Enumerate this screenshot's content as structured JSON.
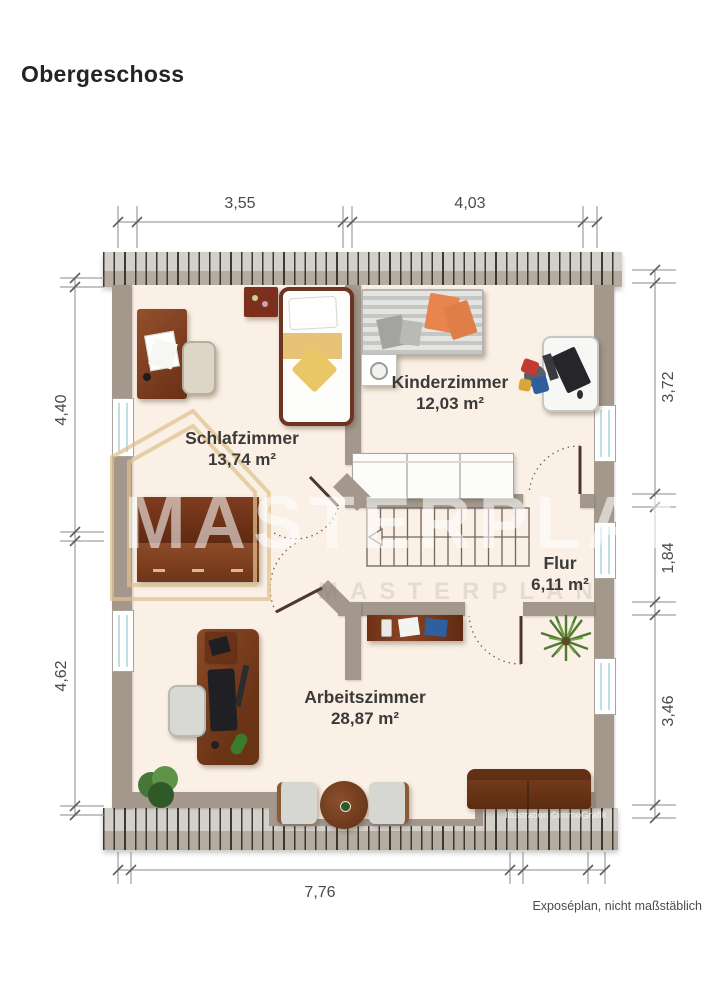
{
  "title": "Obergeschoss",
  "watermark": {
    "text": "MASTERPLAN"
  },
  "rooms": [
    {
      "name": "Schlafzimmer",
      "area": "13,74 m²"
    },
    {
      "name": "Kinderzimmer",
      "area": "12,03 m²"
    },
    {
      "name": "Flur",
      "area": "6,11 m²"
    },
    {
      "name": "Arbeitszimmer",
      "area": "28,87 m²"
    }
  ],
  "dimensions": {
    "top": [
      "3,55",
      "4,03"
    ],
    "left": [
      "4,40",
      "4,62"
    ],
    "right": [
      "3,72",
      "1,84",
      "3,46"
    ],
    "bottom": [
      "7,76"
    ]
  },
  "footer": {
    "note": "Exposéplan, nicht maßstäblich",
    "credit": "Illustration ©immoGrafik"
  },
  "colors": {
    "wall": "#a3988b",
    "floor": "#faf0e6",
    "accent_tan": "#dfc18e"
  }
}
